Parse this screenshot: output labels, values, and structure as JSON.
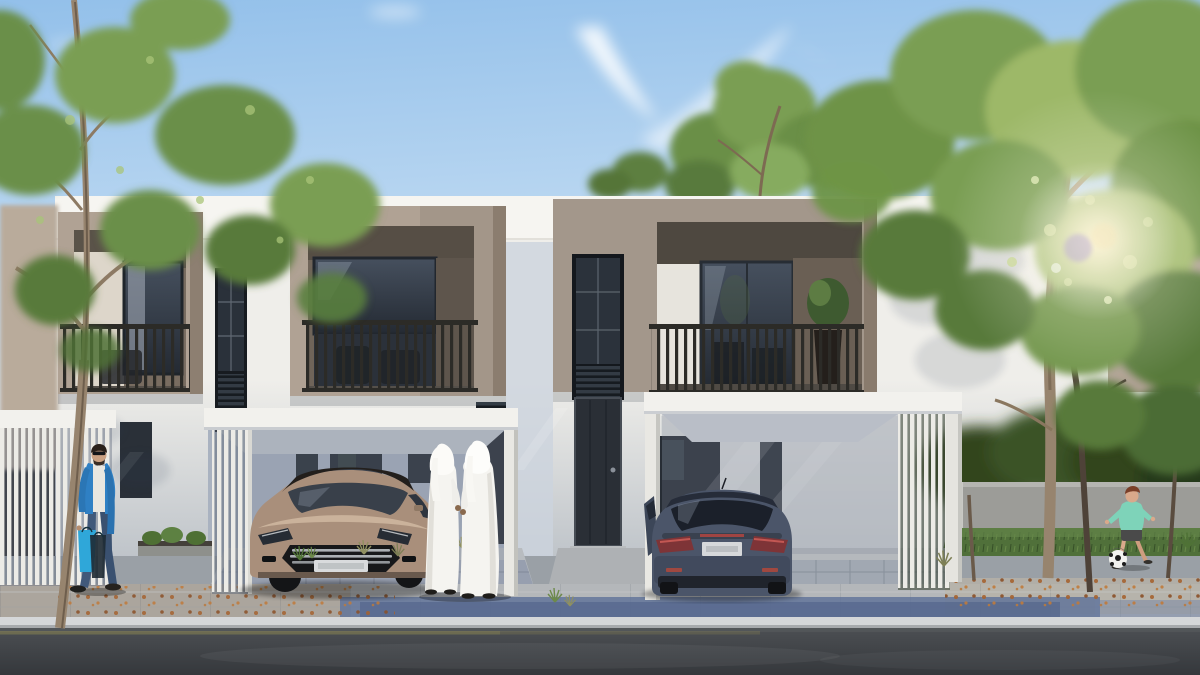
{
  "meta": {
    "type": "architectural-rendering",
    "description": "Daytime 3D rendering of a row of contemporary two-storey townhouses with white render and taupe projecting balcony volumes, white pergola carports with a bronze sedan and a dark blue hatchback, two men in white kanduras standing on the driveway, a man walking with shopping bags on the left sidewalk, a child playing football on the right lawn, trees on both sides, sun glare through foliage, paved sidewalk and asphalt road in the foreground."
  },
  "scene": {
    "sky": {
      "condition": "clear blue with thin wispy clouds",
      "sun": "low sun glare shining through the trees on the right"
    },
    "architecture": {
      "style": "modern flat-roof townhouse row",
      "units_visible": 3,
      "features": [
        "white rendered facade with continuous parapet",
        "taupe projecting first-floor volumes with recessed balconies",
        "dark vertical-baluster balcony railings with outdoor chairs",
        "full-height dark stair windows with louvre panels",
        "tall dark entrance doors",
        "white flat-roof carports with vertical privacy slats"
      ]
    },
    "vehicles": [
      {
        "name": "bronze sedan",
        "view": "front three-quarter",
        "location": "left carport"
      },
      {
        "name": "dark blue hatchback",
        "view": "rear, driver door ajar",
        "location": "right carport"
      }
    ],
    "people": [
      {
        "name": "man walking with shopping bags",
        "clothing": "blue jacket, white shirt, jeans, sunglasses",
        "location": "left sidewalk"
      },
      {
        "name": "two men in white kanduras and ghutras",
        "pose": "standing, seen from behind",
        "location": "central driveway"
      },
      {
        "name": "child kicking a football",
        "clothing": "teal shirt, dark shorts",
        "location": "right lawn"
      }
    ],
    "landscape": [
      "slender leaning tree on the left",
      "large sunlit trees on the right",
      "grey garden boundary wall with dark shrubs behind",
      "lawn with scattered autumn leaves",
      "sidewalk with blue paver band and light curb",
      "dark asphalt road with faint yellow edge line"
    ]
  },
  "palette": {
    "sky_top": "#93c0ea",
    "sky_mid": "#bad7f1",
    "sky_horizon": "#e7eff8",
    "facade_white": "#efeeea",
    "parapet_white": "#f6f5f1",
    "box_taupe": "#b0a294",
    "box_taupe_center": "#a3978b",
    "carport_white": "#f2f1ed",
    "glass_top": "#46505e",
    "glass_bottom": "#242a33",
    "railing_dark": "#2c2b27",
    "sidewalk": "#b4b7ba",
    "paver_blue": "#5e7198",
    "curb": "#d5d7d9",
    "road_top": "#4c4f53",
    "road_bottom": "#35383c",
    "grass": "#50703a",
    "wall_grey": "#9c9c98",
    "foliage_light": "#9db868",
    "foliage_mid": "#7a9e53",
    "foliage_dark": "#587a3b",
    "trunk_light": "#97846e",
    "car_bronze": "#a98f7b",
    "car_blue": "#4b5569",
    "kandura_white": "#f5f4f0",
    "jacket_blue": "#2f80c4",
    "shirt_teal": "#7ed3b9",
    "leaf_litter": "#a5622f",
    "flare_warm": "#fff6da"
  }
}
